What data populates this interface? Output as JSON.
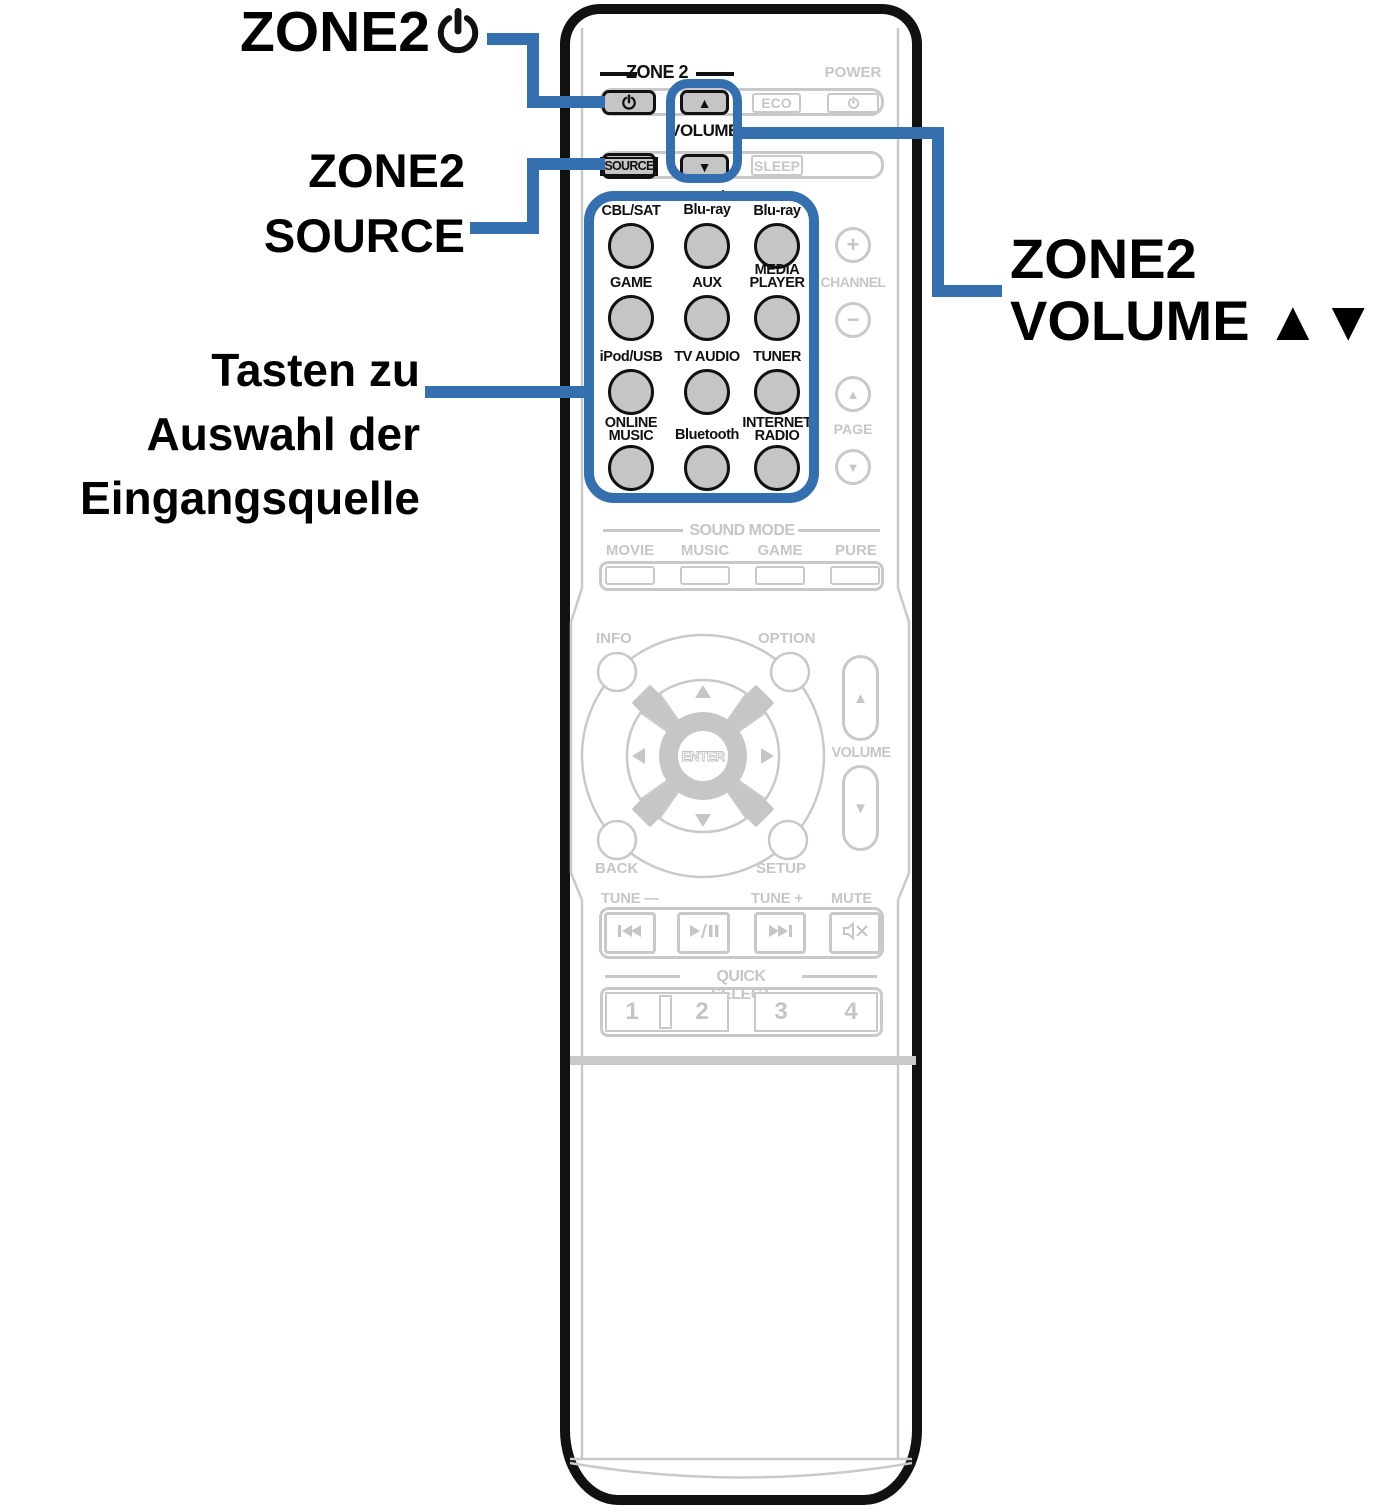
{
  "colors": {
    "blue": "#3470B0",
    "gray_line": "#c9c9c9",
    "gray_text": "#c6c6c6",
    "button_fill": "#c5c5c5",
    "black": "#111111"
  },
  "callouts": {
    "zone2_power": {
      "text": "ZONE2"
    },
    "zone2_source": {
      "line1": "ZONE2",
      "line2": "SOURCE"
    },
    "input_select": {
      "line1": "Tasten zu",
      "line2": "Auswahl der",
      "line3": "Eingangsquelle"
    },
    "zone2_volume": {
      "line1": "ZONE2",
      "line2": "VOLUME ▲▼"
    }
  },
  "remote": {
    "zone2_header": "ZONE 2",
    "power_label": "POWER",
    "volume_label": "VOLUME",
    "eco": "ECO",
    "sleep": "SLEEP",
    "source": "SOURCE",
    "vol_up": "▲",
    "vol_down": "▼",
    "channel": {
      "label": "CHANNEL",
      "plus": "+",
      "minus": "−"
    },
    "page": {
      "label": "PAGE",
      "up": "▲",
      "down": "▼"
    },
    "sources": [
      {
        "l1": "CBL/SAT",
        "l2": ""
      },
      {
        "l1": "DVD/",
        "l2": "Blu-ray"
      },
      {
        "l1": "Blu-ray",
        "l2": ""
      },
      {
        "l1": "GAME",
        "l2": ""
      },
      {
        "l1": "AUX",
        "l2": ""
      },
      {
        "l1": "MEDIA",
        "l2": "PLAYER"
      },
      {
        "l1": "iPod/USB",
        "l2": ""
      },
      {
        "l1": "TV AUDIO",
        "l2": ""
      },
      {
        "l1": "TUNER",
        "l2": ""
      },
      {
        "l1": "ONLINE",
        "l2": "MUSIC"
      },
      {
        "l1": "Bluetooth",
        "l2": ""
      },
      {
        "l1": "INTERNET",
        "l2": "RADIO"
      }
    ],
    "sound_mode": {
      "header": "SOUND MODE",
      "movie": "MOVIE",
      "music": "MUSIC",
      "game": "GAME",
      "pure": "PURE"
    },
    "nav": {
      "info": "INFO",
      "option": "OPTION",
      "back": "BACK",
      "setup": "SETUP",
      "enter": "ENTER"
    },
    "side_volume": {
      "label": "VOLUME",
      "up": "▲",
      "down": "▼"
    },
    "transport": {
      "tune_minus": "TUNE —",
      "tune_plus": "TUNE +",
      "mute": "MUTE"
    },
    "quick_select": {
      "header": "QUICK SELECT",
      "b1": "1",
      "b2": "2",
      "b3": "3",
      "b4": "4"
    }
  }
}
